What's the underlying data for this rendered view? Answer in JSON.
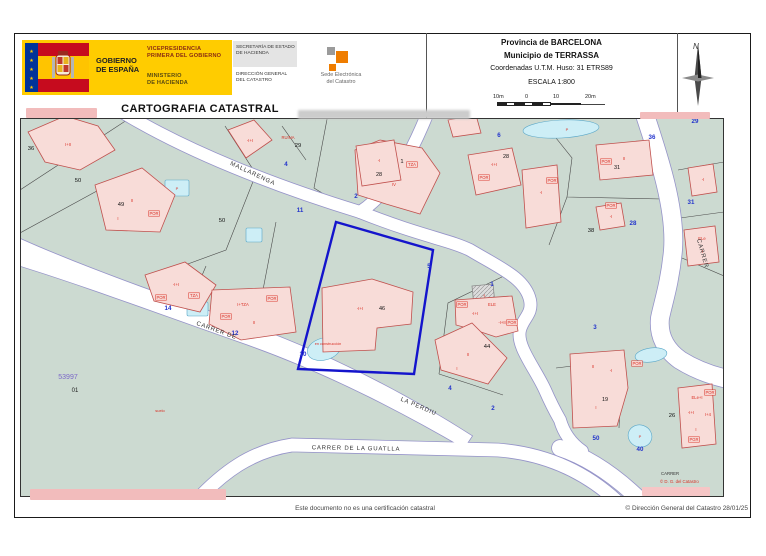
{
  "header": {
    "gobierno_line1": "GOBIERNO",
    "gobierno_line2": "DE ESPAÑA",
    "vice1": "VICEPRESIDENCIA",
    "vice2": "PRIMERA DEL GOBIERNO",
    "min1": "MINISTERIO",
    "min2": "DE HACIENDA",
    "sec1": "SECRETARÍA DE ESTADO",
    "sec2": "DE HACIENDA",
    "dg1": "DIRECCIÓN GENERAL",
    "dg2": "DEL CATASTRO",
    "sede1": "Sede Electrónica",
    "sede2": "del Catastro",
    "title": "CARTOGRAFIA CATASTRAL",
    "provincia": "Provincia de BARCELONA",
    "municipio": "Municipio de TERRASSA",
    "coords": "Coordenadas U.T.M. Huso: 31 ETRS89",
    "escala": "ESCALA 1:800",
    "scale_ticks": [
      "10m",
      "0",
      "10",
      "20m"
    ],
    "compass_n": "N"
  },
  "footer": {
    "disclaimer": "Este documento no es una certificación catastral",
    "copyright": "© Dirección General del Catastro 28/01/25"
  },
  "map": {
    "bg": "#ccdad1",
    "street_fill": "#ffffff",
    "street_casing": "#9593c9",
    "boundary_color": "#4a4a4a",
    "building_fill": "#f8dcd8",
    "building_stroke": "#c0504d",
    "gray_fill": "#dcdcdc",
    "pool_fill": "#cdeef6",
    "pool_stroke": "#5aa7c8",
    "highlight_color": "#1414cc",
    "blue": "#2233cc",
    "red": "#d93025",
    "purple": "#7b68c8",
    "streets": [
      {
        "d": "M102,-6 C168,34 255,68 340,94",
        "w": 12
      },
      {
        "d": "M408,-6 C390,40 368,76 340,94",
        "w": 12
      },
      {
        "d": "M340,94 C400,118 430,122 450,132 C480,150 505,160 510,182 C513,196 503,200 500,212 C496,228 515,250 525,272 C532,288 536,295 540,302 C544,316 552,326 562,333",
        "w": 12
      },
      {
        "d": "M624,-6 C640,42 656,92 653,132 C650,165 643,185 640,200 C638,218 646,232 660,242 C676,252 692,258 712,262",
        "w": 18
      },
      {
        "d": "M168,392 C203,352 233,333 272,327 L478,332 C530,336 572,357 606,392",
        "w": 13
      },
      {
        "d": "M540,330 C570,340 600,360 632,394",
        "w": 16
      }
    ],
    "street_taper": "M-6,118 C60,148 140,176 220,204 C300,232 380,272 452,318 L444,330 C372,288 300,252 220,224 C140,196 60,166 -6,146 Z",
    "boundaries": [
      "M0,72 L110,0",
      "M205,8 L236,56 L206,132 L146,154",
      "M0,115 L86,68",
      "M262,8 L286,42",
      "M308,-4 L294,70 L336,96",
      "M186,148 L170,186",
      "M256,104 L238,198",
      "M528,10 L552,40 L547,79 L642,81",
      "M547,79 L529,127",
      "M658,52 L704,44",
      "M660,100 L704,94",
      "M662,140 L704,158",
      "M488,156 L428,185 L419,256",
      "M419,256 L450,266 L483,277",
      "M536,250 L602,242 L599,310"
    ],
    "buildings": [
      {
        "p": "8,14 45,-2 78,8 95,32 60,52 25,44",
        "l": [
          [
            "I+II",
            48,
            28
          ]
        ]
      },
      {
        "p": "208,12 234,2 252,22 226,40",
        "l": [
          [
            "-I+I",
            230,
            24
          ]
        ]
      },
      {
        "p": "75,67 122,50 155,77 140,114 86,112",
        "l": [
          [
            "II",
            112,
            84
          ],
          [
            "I",
            98,
            102
          ],
          [
            "POR",
            134,
            97,
            1
          ]
        ]
      },
      {
        "p": "335,32 360,22 402,30 420,55 400,96 366,86 338,77",
        "l": [
          [
            "I+T",
            362,
            50
          ],
          [
            "TZA",
            392,
            48,
            1
          ],
          [
            "IV",
            374,
            68
          ],
          [
            "II",
            344,
            68
          ]
        ]
      },
      {
        "p": "428,2 456,-3 461,15 433,19",
        "l": []
      },
      {
        "p": "125,157 165,144 196,167 180,194 134,183",
        "l": [
          [
            "-I+I",
            156,
            168
          ],
          [
            "TZA",
            174,
            179,
            1
          ],
          [
            "POR",
            141,
            181,
            1
          ]
        ]
      },
      {
        "p": "192,172 270,169 276,214 221,222 189,206",
        "l": [
          [
            "I+TZA",
            223,
            188
          ],
          [
            "POR",
            252,
            182,
            1
          ],
          [
            "II",
            234,
            206
          ],
          [
            "POR",
            206,
            200,
            1
          ]
        ]
      },
      {
        "p": "336,28 374,22 381,62 342,68",
        "l": [
          [
            "-I",
            359,
            44
          ]
        ],
        "n": [
          "28",
          359,
          58
        ]
      },
      {
        "p": "448,37 492,30 501,67 456,77",
        "l": [
          [
            "-I+I",
            474,
            48
          ],
          [
            "POR",
            464,
            61,
            1
          ]
        ],
        "n": [
          "28",
          486,
          40
        ]
      },
      {
        "p": "502,52 537,47 541,104 506,110",
        "l": [
          [
            "-I",
            521,
            76
          ],
          [
            "POR",
            532,
            64,
            1
          ]
        ]
      },
      {
        "p": "576,27 629,22 633,57 580,62",
        "l": [
          [
            "II",
            604,
            42
          ],
          [
            "POR",
            586,
            45,
            1
          ]
        ],
        "n": [
          "31",
          597,
          51
        ]
      },
      {
        "p": "576,89 601,85 605,108 580,112",
        "l": [
          [
            "-I",
            591,
            100
          ],
          [
            "POR",
            591,
            89,
            1
          ]
        ]
      },
      {
        "p": "668,50 693,46 697,74 672,78",
        "l": [
          [
            "-I",
            683,
            63
          ]
        ]
      },
      {
        "p": "664,112 695,108 699,144 668,148",
        "l": [
          [
            "ELe",
            682,
            122
          ],
          [
            "-I",
            682,
            135
          ]
        ]
      },
      {
        "p": "302,170 352,161 393,174 391,206 357,210 355,232 303,234",
        "l": [
          [
            "-I+I",
            340,
            192
          ]
        ],
        "n": [
          "46",
          362,
          192
        ]
      },
      {
        "p": "452,168 473,166 475,186 454,188",
        "l": [
          [
            "-I",
            464,
            179
          ]
        ],
        "g": 1
      },
      {
        "p": "435,182 492,178 498,213 476,219 458,213 436,207",
        "l": [
          [
            "POR",
            442,
            188,
            1
          ],
          [
            "-I+I",
            455,
            197
          ],
          [
            "ELE",
            472,
            188
          ],
          [
            "-I+II",
            482,
            206
          ],
          [
            "POR",
            492,
            206,
            1
          ]
        ]
      },
      {
        "p": "415,222 452,205 487,240 468,266 421,252",
        "l": [
          [
            "II",
            448,
            238
          ],
          [
            "I",
            437,
            252
          ]
        ]
      },
      {
        "p": "550,236 604,232 608,270 597,308 553,310",
        "l": [
          [
            "II",
            573,
            250
          ],
          [
            "-I",
            591,
            254
          ],
          [
            "I",
            576,
            291
          ]
        ],
        "n": [
          "19",
          585,
          283
        ]
      },
      {
        "p": "658,270 692,266 696,326 662,330",
        "l": [
          [
            "ELe+I",
            677,
            281
          ],
          [
            "POR",
            690,
            276,
            1
          ],
          [
            "-I+I",
            671,
            296
          ],
          [
            "I+4",
            688,
            298
          ],
          [
            "I",
            676,
            313
          ],
          [
            "PGR",
            674,
            323,
            1
          ]
        ]
      }
    ],
    "pools": [
      {
        "t": "r",
        "x": 145,
        "y": 62,
        "w": 24,
        "h": 16,
        "lb": [
          "P",
          157,
          72
        ]
      },
      {
        "t": "r",
        "x": 226,
        "y": 110,
        "w": 16,
        "h": 14
      },
      {
        "t": "r",
        "x": 167,
        "y": 184,
        "w": 21,
        "h": 14,
        "lb": [
          "P",
          177,
          193
        ]
      },
      {
        "t": "e",
        "cx": 541,
        "cy": 11,
        "rx": 38,
        "ry": 9,
        "rot": -3,
        "lb": [
          "P",
          547,
          13
        ]
      },
      {
        "t": "e",
        "cx": 304,
        "cy": 231,
        "rx": 17,
        "ry": 11,
        "rot": -15
      },
      {
        "t": "e",
        "cx": 631,
        "cy": 237,
        "rx": 16,
        "ry": 7,
        "rot": -8
      },
      {
        "t": "e",
        "cx": 620,
        "cy": 318,
        "rx": 12,
        "ry": 11,
        "rot": 20,
        "lb": [
          "P",
          620,
          320
        ]
      }
    ],
    "highlight": {
      "points": "316,104 413,132 394,256 278,251"
    },
    "blue_numbers": [
      [
        "4",
        266,
        48
      ],
      [
        "2",
        336,
        80
      ],
      [
        "11",
        280,
        94
      ],
      [
        "6",
        479,
        19
      ],
      [
        "29",
        675,
        5
      ],
      [
        "36",
        632,
        21
      ],
      [
        "31",
        671,
        86
      ],
      [
        "28",
        613,
        107
      ],
      [
        "1",
        472,
        168
      ],
      [
        "5",
        409,
        150
      ],
      [
        "10",
        283,
        238
      ],
      [
        "14",
        148,
        192
      ],
      [
        "12",
        215,
        217
      ],
      [
        "3",
        575,
        211
      ],
      [
        "4",
        430,
        272
      ],
      [
        "2",
        473,
        292
      ],
      [
        "50",
        576,
        322
      ],
      [
        "40",
        620,
        333
      ]
    ],
    "black_numbers": [
      [
        "36",
        11,
        32
      ],
      [
        "50",
        58,
        64
      ],
      [
        "49",
        101,
        88
      ],
      [
        "50",
        202,
        104
      ],
      [
        "29",
        278,
        29
      ],
      [
        "1",
        382,
        45
      ],
      [
        "44",
        467,
        230
      ],
      [
        "26",
        652,
        299
      ],
      [
        "38",
        571,
        114
      ]
    ],
    "boxed": [
      [
        "POR",
        617,
        247
      ]
    ],
    "misc_texts": [
      {
        "t": "CARRER",
        "x": 641,
        "y": 357,
        "s": 4.3,
        "c": "#333333",
        "a": "start"
      },
      {
        "t": "© D. G. del Catastro",
        "x": 640,
        "y": 365,
        "s": 4.3,
        "c": "#d93025",
        "a": "start"
      },
      {
        "t": "RUINA",
        "x": 268,
        "y": 21,
        "s": 4.2,
        "c": "#d93025"
      },
      {
        "t": "suelo",
        "x": 140,
        "y": 294,
        "s": 4,
        "c": "#d93025"
      },
      {
        "t": "en construcción",
        "x": 308,
        "y": 227,
        "s": 3.8,
        "c": "#d93025"
      },
      {
        "t": "53997",
        "x": 48,
        "y": 261,
        "s": 7,
        "c": "#7b68c8"
      },
      {
        "t": "01",
        "x": 55,
        "y": 274,
        "s": 6,
        "c": "#222222"
      }
    ],
    "street_labels": [
      {
        "t": "MALLARENGA",
        "x": 232,
        "y": 57,
        "r": 25
      },
      {
        "t": "CARRER DE",
        "x": 196,
        "y": 214,
        "r": 20
      },
      {
        "t": "LA PERDIU",
        "x": 398,
        "y": 290,
        "r": 23
      },
      {
        "t": "CARRER DE LA GUATLLA",
        "x": 336,
        "y": 332,
        "r": 1
      },
      {
        "t": "CARRER",
        "x": 681,
        "y": 136,
        "r": 74
      }
    ],
    "redactions": [
      {
        "x": 26,
        "y": 108,
        "w": 71,
        "h": 10,
        "c": "#f2bcbc"
      },
      {
        "x": 298,
        "y": 110,
        "w": 172,
        "h": 9,
        "c": "#cccccc",
        "blur": true
      },
      {
        "x": 640,
        "y": 112,
        "w": 70,
        "h": 7,
        "c": "#f2bcbc"
      },
      {
        "x": 30,
        "y": 489,
        "w": 196,
        "h": 11,
        "c": "#f2bcbc"
      },
      {
        "x": 642,
        "y": 487,
        "w": 68,
        "h": 9,
        "c": "#f6c6c6"
      }
    ]
  }
}
